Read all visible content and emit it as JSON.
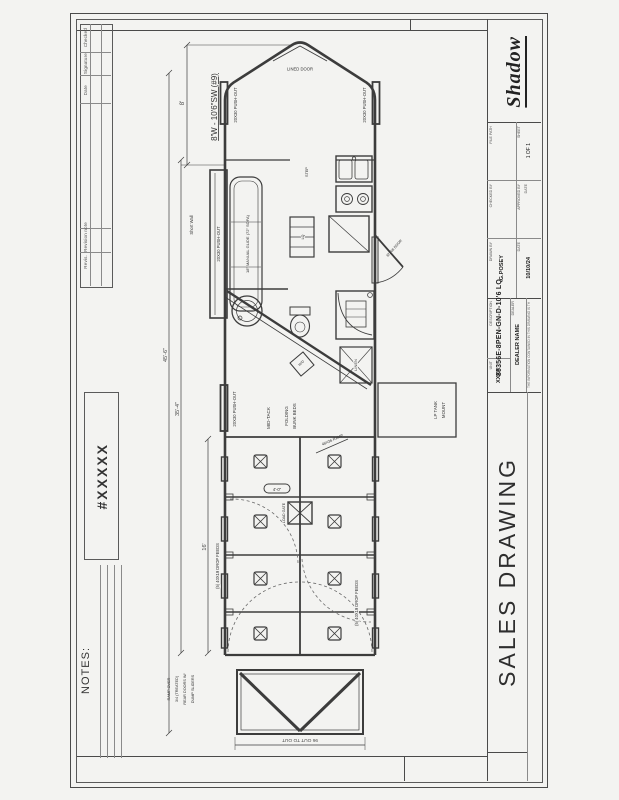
{
  "colors": {
    "ink": "#3c3c3c",
    "paper": "#f3f3f1",
    "faint": "#8a8a8a"
  },
  "title_block": {
    "logo": "Shadow",
    "file_path_label": "FILE PATH",
    "checked_by_label": "CHECKED BY",
    "approved_label": "APPROVED BY",
    "approved_date_label": "DATE",
    "sheet_label": "SHEET",
    "sheet_value": "1 OF 1",
    "drawn_by_label": "DRAWN BY",
    "drawn_by": "G.POSEY",
    "date_label": "DATE",
    "date": "10/10/24",
    "description_label": "DESCRIPTION",
    "model": "80356E-8PEN-GN-D-10'6 LQ",
    "dealer_label": "DEALER",
    "dealer": "DEALER NAME",
    "unit_label": "UNIT",
    "unit": "XXXX",
    "disclaimer": "THE INFORMATION CONTAINED IN THIS DRAWING IS THE SOLE PROPERTY OF SHADOW TRAILER. ANY REPRODUCTION IN PART OR AS A WHOLE WITHOUT WRITTEN PERMISSION IS PROHIBITED.",
    "sales_drawing": "SALES DRAWING"
  },
  "revision_table": {
    "headers": [
      "Revis.",
      "Revision note",
      "Date",
      "Signature",
      "Checked"
    ]
  },
  "notes": {
    "label": "NOTES:",
    "number": "#XXXXX"
  },
  "plan": {
    "callout": "8'W - 10'6\"SW (#9)",
    "nose_door": "LINED DOOR",
    "window": "20X30 PUSH-OUT",
    "sofa": "18\" MANUAL GLIDE (72\" SOFA)",
    "short_wall": "Short Wall",
    "step": "STEP",
    "table": "LQ",
    "entry_door": "32X68 DOOR",
    "wd": "W/D",
    "linen": "LINEN",
    "mid_tack": "MID-TACK",
    "bunks_1": "FOLDING",
    "bunks_2": "BUNK BEDS",
    "lp_1": "LP TANK",
    "lp_2": "MOUNT",
    "drop_feeds": "(5) 40X19 DROP FEEDS",
    "load_gate": "LOAD GATE",
    "gate_width": "4'-0\"",
    "ramp_callout": "48X36 RAMP",
    "ramp_note_1": "RAMP OVER",
    "ramp_note_2": "3/4 (TREATED)",
    "ramp_note_3": "REAR DOORS W/",
    "ramp_note_4": "DUMP SLIDERS",
    "dim_nose": "8'",
    "dim_total": "45'-6\"",
    "dim_box": "35'-4\"",
    "dim_stalls": "16'",
    "dim_rear": "96 OUT TO OUT"
  }
}
